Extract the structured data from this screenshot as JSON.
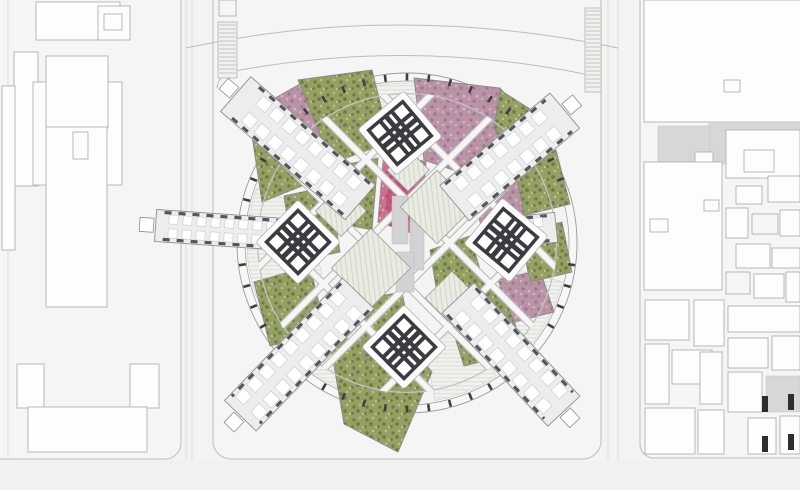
{
  "scene": {
    "kind": "architectural-master-plan",
    "width": 800,
    "height": 490
  },
  "palette": {
    "background": "#f3f3f4",
    "plate": "#f5f5f6",
    "street": "#fafafb",
    "building_fill": "#fdfdfe",
    "building_stroke": "#b2b2b6",
    "outline_stroke": "#a8a8ac",
    "gray_fill": "#d7d7d9",
    "black_fill": "#2e2e30",
    "boundary_stroke": "#c6c6c9",
    "road_stroke": "#bcbcbf",
    "ring_stroke": "#9b9ba0",
    "ring_fill_outer": "#f7f7f6",
    "ring_fill_inner": "#f4f4f3",
    "tick_fill": "#3f3f42",
    "fan_bg": "#f1f2ee",
    "fan_line": "#d8dad2",
    "glass_bg": "#e9ece2",
    "glass_line": "#cdd2c4",
    "veg_green": "#95a163",
    "veg_green_dark": "#6d7c49",
    "veg_green_light": "#bac48b",
    "veg_pink": "#bb93a8",
    "veg_pink_dark": "#a27691",
    "veg_pink_light": "#d6b7c7",
    "veg_bright": "#c97390",
    "veg_bright_dark": "#bd4f6e",
    "veg_bright_light": "#e2a9be",
    "patch_stroke": "#87898c",
    "lattice_under": "#c0c0c3",
    "lattice_over": "#f6f6f5",
    "wing_fill": "#ededee",
    "wing_stroke": "#8f8f93",
    "wing_dash": "#53565a",
    "module_fill": "#ffffff",
    "module_stroke": "#c9c9cb",
    "core_dark": "#3a3d40",
    "core_plinth": "#fcfcfd",
    "shaft_gray": "#d2d2d4",
    "ramp_line": "#b7b7ad"
  },
  "center": {
    "cx": 407,
    "cy": 243,
    "r_outer": 170,
    "r_inner": 162,
    "tick_radius": 166,
    "tick_step": 7.5,
    "lattice_offsets": [
      -88,
      -30,
      30,
      88
    ],
    "lattice_clip_r": 150,
    "ring_road_r": 152
  },
  "roads": {
    "vertical_x": [
      8,
      186,
      192,
      608,
      618
    ],
    "arcs": [
      "M186 48 Q400 2 618 48",
      "M230 72 Q406 38 584 74"
    ]
  },
  "plates": {
    "left": {
      "x": -30,
      "y": -30,
      "w": 211,
      "h": 489,
      "r": 16
    },
    "center": {
      "x": 213,
      "y": -30,
      "w": 388,
      "h": 489,
      "r": 18
    },
    "right": {
      "x": 640,
      "y": -30,
      "w": 200,
      "h": 488,
      "r": 14
    }
  },
  "ramps": [
    {
      "x": 218,
      "y": 22,
      "w": 19,
      "h": 56
    },
    {
      "x": 585,
      "y": 8,
      "w": 16,
      "h": 84
    }
  ],
  "center_misc": [
    [
      219,
      0,
      17,
      16,
      "o"
    ]
  ],
  "left_buildings": [
    [
      36,
      2,
      84,
      38,
      "b"
    ],
    [
      98,
      6,
      32,
      34,
      "b"
    ],
    [
      104,
      14,
      18,
      16,
      "o"
    ],
    [
      14,
      52,
      24,
      134,
      "b"
    ],
    [
      2,
      86,
      13,
      164,
      "b"
    ],
    [
      33,
      82,
      89,
      103,
      "b"
    ],
    [
      46,
      56,
      62,
      72,
      "b"
    ],
    [
      46,
      127,
      61,
      180,
      "b"
    ],
    [
      73,
      132,
      15,
      27,
      "o"
    ],
    [
      17,
      364,
      27,
      44,
      "b"
    ],
    [
      130,
      364,
      29,
      44,
      "b"
    ],
    [
      28,
      407,
      119,
      45,
      "b"
    ]
  ],
  "right_buildings": [
    [
      644,
      0,
      160,
      122,
      "b"
    ],
    [
      724,
      80,
      16,
      12,
      "o"
    ],
    [
      709,
      122,
      95,
      42,
      "g"
    ],
    [
      658,
      126,
      52,
      36,
      "g"
    ],
    [
      695,
      152,
      18,
      16,
      "b"
    ],
    [
      644,
      162,
      78,
      128,
      "b"
    ],
    [
      650,
      219,
      18,
      13,
      "o"
    ],
    [
      704,
      200,
      15,
      11,
      "o"
    ],
    [
      726,
      130,
      74,
      48,
      "b"
    ],
    [
      744,
      150,
      30,
      22,
      "o"
    ],
    [
      736,
      186,
      26,
      18,
      "b"
    ],
    [
      768,
      176,
      32,
      26,
      "b"
    ],
    [
      726,
      208,
      22,
      30,
      "b"
    ],
    [
      752,
      214,
      26,
      20,
      "o"
    ],
    [
      780,
      210,
      20,
      26,
      "b"
    ],
    [
      736,
      244,
      34,
      24,
      "b"
    ],
    [
      772,
      248,
      28,
      20,
      "b"
    ],
    [
      726,
      272,
      24,
      22,
      "o"
    ],
    [
      754,
      274,
      30,
      24,
      "b"
    ],
    [
      786,
      272,
      14,
      30,
      "b"
    ],
    [
      645,
      300,
      44,
      40,
      "b"
    ],
    [
      694,
      300,
      30,
      46,
      "b"
    ],
    [
      645,
      344,
      24,
      60,
      "b"
    ],
    [
      672,
      350,
      40,
      34,
      "b"
    ],
    [
      645,
      408,
      50,
      46,
      "b"
    ],
    [
      700,
      352,
      22,
      52,
      "b"
    ],
    [
      698,
      410,
      26,
      44,
      "b"
    ],
    [
      728,
      306,
      72,
      26,
      "b"
    ],
    [
      728,
      338,
      40,
      30,
      "b"
    ],
    [
      772,
      336,
      28,
      34,
      "b"
    ],
    [
      728,
      372,
      34,
      40,
      "b"
    ],
    [
      766,
      376,
      34,
      36,
      "g"
    ],
    [
      748,
      418,
      28,
      36,
      "b"
    ],
    [
      780,
      416,
      20,
      38,
      "b"
    ],
    [
      762,
      396,
      6,
      16,
      "k"
    ],
    [
      762,
      436,
      6,
      16,
      "k"
    ],
    [
      788,
      394,
      6,
      16,
      "k"
    ],
    [
      788,
      434,
      6,
      16,
      "k"
    ]
  ],
  "fans": [
    {
      "a1": -118,
      "a2": -60,
      "r1": 92,
      "r2": 160
    },
    {
      "a1": 160,
      "a2": 200,
      "r1": 90,
      "r2": 160
    },
    {
      "a1": 112,
      "a2": 133,
      "r1": 95,
      "r2": 160
    },
    {
      "a1": 14,
      "a2": 40,
      "r1": 95,
      "r2": 160
    },
    {
      "a1": 56,
      "a2": 80,
      "r1": 100,
      "r2": 160
    }
  ],
  "vegetation": [
    {
      "type": "g",
      "pts": "298,80 372,70 390,142 330,164"
    },
    {
      "type": "p",
      "pts": "268,102 300,84 332,166 284,188"
    },
    {
      "type": "g",
      "pts": "252,136 286,122 302,186 262,202"
    },
    {
      "type": "p",
      "pts": "414,78 500,88 534,128 470,176 424,160"
    },
    {
      "type": "g",
      "pts": "500,90 538,114 548,142 520,160 494,128"
    },
    {
      "type": "g",
      "pts": "506,168 556,150 570,204 522,216"
    },
    {
      "type": "p",
      "pts": "470,182 516,172 526,226 482,230"
    },
    {
      "type": "pb",
      "pts": "384,150 426,162 420,236 378,222"
    },
    {
      "type": "g",
      "pts": "338,166 378,158 372,230 332,222"
    },
    {
      "type": "g",
      "pts": "284,196 330,186 340,252 294,262"
    },
    {
      "type": "g",
      "pts": "254,282 310,266 326,332 270,346"
    },
    {
      "type": "g",
      "pts": "330,342 396,330 432,372 398,452 344,424"
    },
    {
      "type": "g",
      "pts": "444,302 506,286 522,352 464,366"
    },
    {
      "type": "p",
      "pts": "498,280 540,270 554,312 514,322"
    },
    {
      "type": "g",
      "pts": "520,232 562,222 572,272 530,282"
    },
    {
      "type": "g",
      "pts": "356,300 402,292 414,352 366,360"
    },
    {
      "type": "g",
      "pts": "430,250 470,236 488,296 440,312"
    }
  ],
  "shafts": [
    [
      392,
      196,
      16,
      48
    ],
    [
      410,
      218,
      14,
      52
    ],
    [
      396,
      252,
      18,
      40
    ]
  ],
  "glass_diamonds": [
    [
      437,
      207,
      52
    ],
    [
      371,
      268,
      56
    ],
    [
      452,
      298,
      38
    ],
    [
      341,
      211,
      36
    ],
    [
      408,
      170,
      30
    ]
  ],
  "wings": [
    {
      "a": -40,
      "r0": 62,
      "r1": 206,
      "w": 46
    },
    {
      "a": -139,
      "r0": 62,
      "r1": 227,
      "w": 46
    },
    {
      "a": 47,
      "r0": 75,
      "r1": 230,
      "w": 44
    },
    {
      "a": 134,
      "r0": 70,
      "r1": 240,
      "w": 44
    },
    {
      "a": 184,
      "r0": 92,
      "r1": 252,
      "w": 32
    },
    {
      "a": -6,
      "r0": 88,
      "r1": 150,
      "w": 30
    }
  ],
  "tick_skip_angles": [
    -40,
    -139,
    47,
    134,
    184,
    -6
  ],
  "cores": [
    {
      "x": 400,
      "y": 133,
      "rot": -40
    },
    {
      "x": 298,
      "y": 242,
      "rot": 45
    },
    {
      "x": 506,
      "y": 240,
      "rot": 40
    },
    {
      "x": 404,
      "y": 347,
      "rot": 45
    }
  ]
}
